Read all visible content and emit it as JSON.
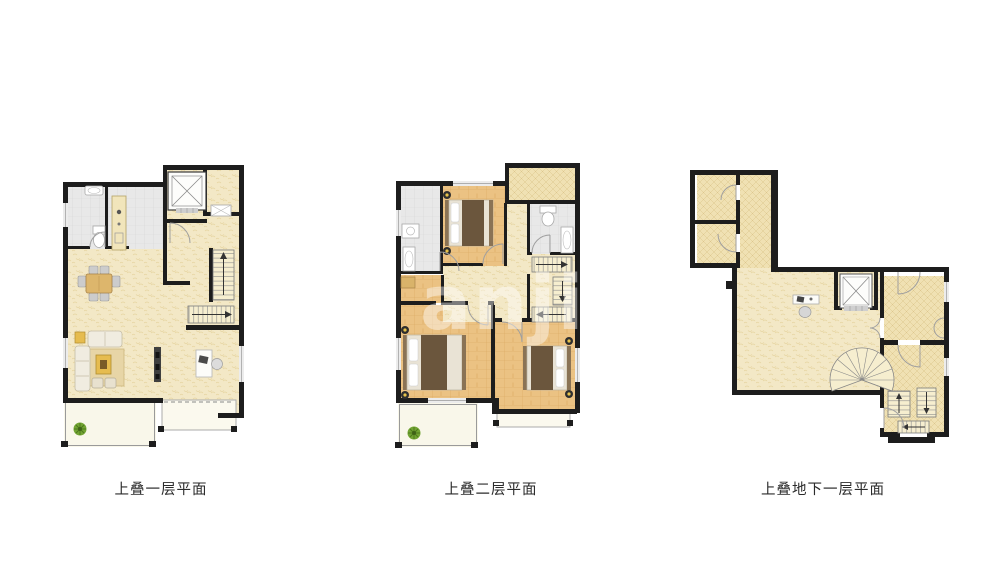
{
  "page": {
    "background": "#ffffff",
    "width": 983,
    "height": 576
  },
  "watermark": {
    "text": "anjia",
    "color": "#ffffff",
    "opacity": 0.42
  },
  "plans": [
    {
      "id": "first-floor",
      "caption": "上叠一层平面"
    },
    {
      "id": "second-floor",
      "caption": "上叠二层平面"
    },
    {
      "id": "basement",
      "caption": "上叠地下一层平面"
    }
  ],
  "colors": {
    "wall": "#1d1d1d",
    "floor_main": "#f3e8c6",
    "floor_hatch": "#f0e1b3",
    "floor_wood": "#ebc283",
    "floor_tile": "#e8e8e8",
    "balcony": "#f9f7ea",
    "stair": "#f6eecf",
    "bed_blanket": "#6b563d",
    "bed_frame": "#8a7355",
    "table_accent": "#e6bc4f",
    "dining_table": "#ddb66c",
    "plant": "#72a433",
    "lamp": "#e8c34a"
  },
  "legend": {
    "elevator_icon": "square shaft with X cross",
    "stairs_icon": "stepped treads with direction arrow",
    "spiral_stairs_icon": "fan shaped treads",
    "plant_icon": "green potted plant",
    "bed_icon": "mattress with pillows and dark blanket",
    "door_icon": "quarter-circle swing arc"
  }
}
